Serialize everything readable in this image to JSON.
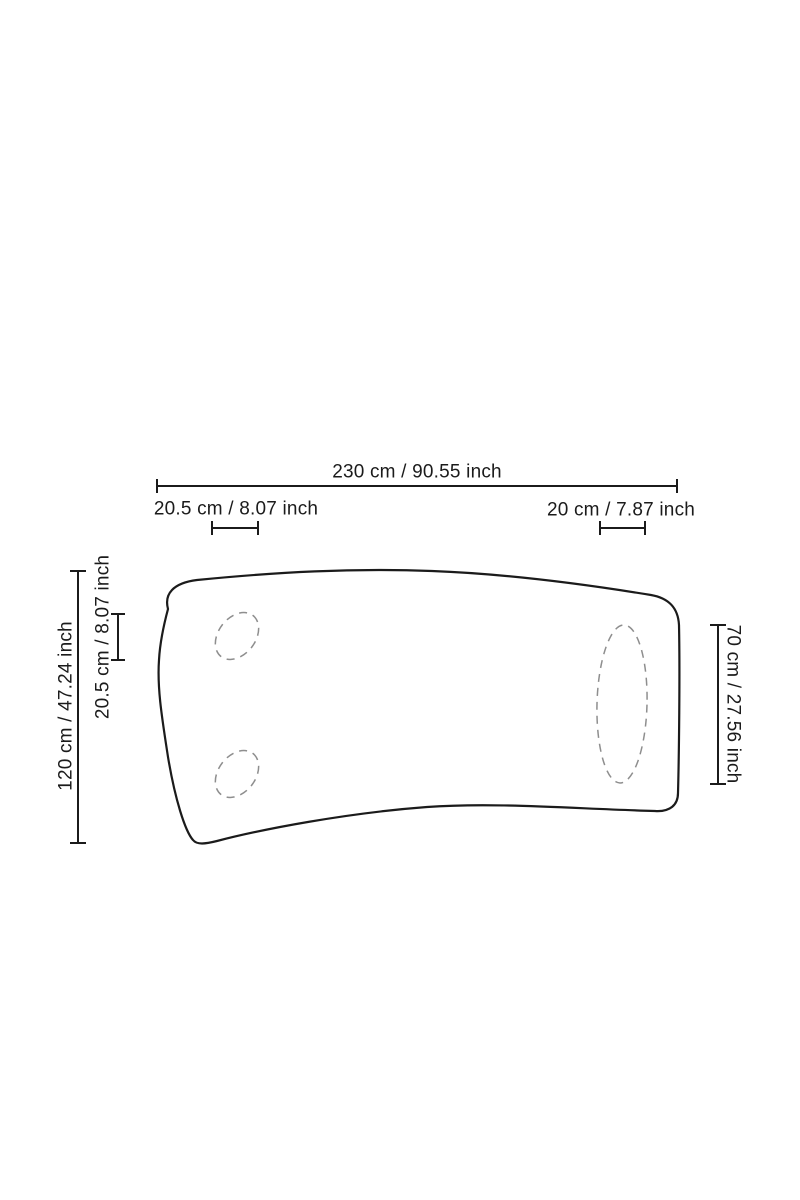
{
  "measurements": {
    "total_width": {
      "cm": "230",
      "inch": "90.55",
      "label": "230 cm / 90.55 inch"
    },
    "left_edge_offset_width": {
      "cm": "20.5",
      "inch": "8.07",
      "label": "20.5 cm / 8.07 inch"
    },
    "right_edge_offset_width": {
      "cm": "20",
      "inch": "7.87",
      "label": "20 cm / 7.87 inch"
    },
    "total_depth": {
      "cm": "120",
      "inch": "47.24",
      "label": "120 cm / 47.24 inch"
    },
    "left_edge_offset_depth": {
      "cm": "20.5",
      "inch": "8.07",
      "label": "20.5 cm / 8.07 inch"
    },
    "right_side_depth": {
      "cm": "70",
      "inch": "27.56",
      "label": "70 cm / 27.56 inch"
    }
  },
  "colors": {
    "outline": "#1b1b1b",
    "dimension": "#1b1b1b",
    "text": "#1b1b1b",
    "hidden-detail": "#8e8e8e",
    "background": "#ffffff"
  }
}
